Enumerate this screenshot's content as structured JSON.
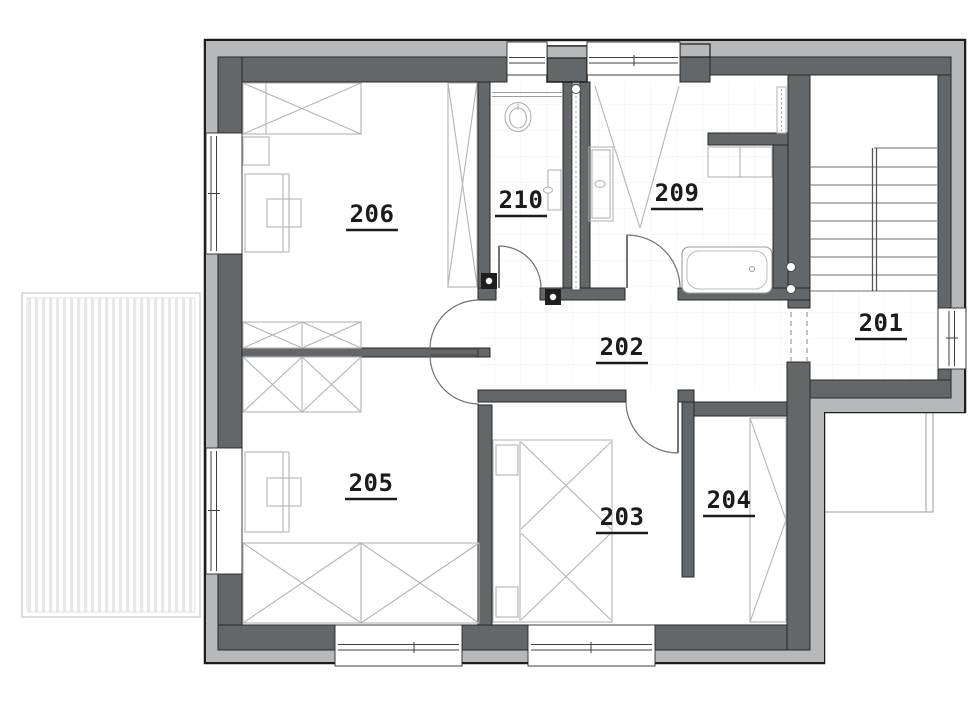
{
  "colors": {
    "wall": "#646769",
    "insulation": "#b6b8ba",
    "outline": "#1c1c1c",
    "furniture_line": "#b4b4b6",
    "label_text": "#1b1b1b",
    "deck_stripe": "#e7e7e7",
    "tile_grid": "#f0f0f1"
  },
  "plan": {
    "rooms": [
      {
        "label": "201"
      },
      {
        "label": "202"
      },
      {
        "label": "203"
      },
      {
        "label": "204"
      },
      {
        "label": "205"
      },
      {
        "label": "206"
      },
      {
        "label": "209"
      },
      {
        "label": "210"
      }
    ],
    "fixtures": [
      "terrace-deck",
      "staircase",
      "bathtub",
      "shower",
      "toilet",
      "washbasin",
      "radiator",
      "towel-radiator",
      "bed-single",
      "bed-double",
      "desk",
      "chair",
      "nightstand",
      "wardrobe",
      "cabinet",
      "window",
      "door"
    ]
  }
}
